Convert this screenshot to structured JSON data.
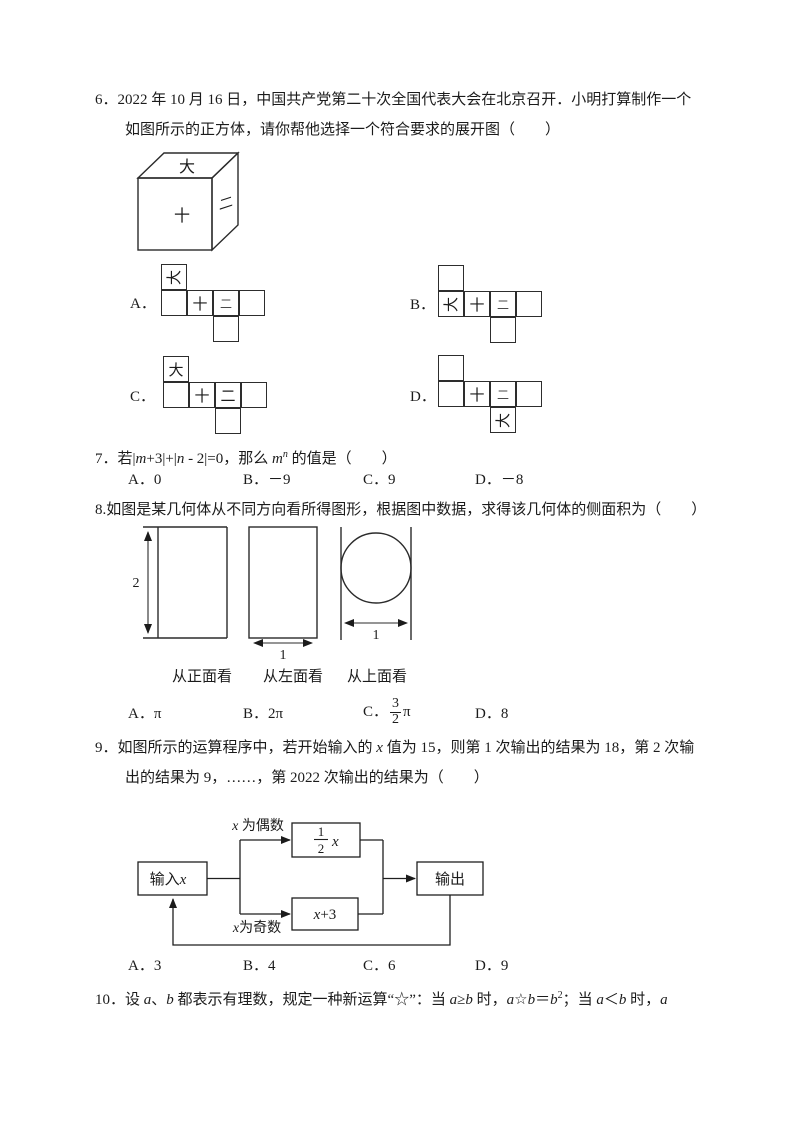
{
  "q6": {
    "num": "6．",
    "line1": "2022 年 10 月 16 日，中国共产党第二十次全国代表大会在北京召开．小明打算制作一个",
    "line2": "如图所示的正方体，请你帮他选择一个符合要求的展开图（　　）",
    "cube": {
      "top": "大",
      "front": "十",
      "side": "二"
    },
    "options": [
      {
        "label": "A．",
        "top": "大",
        "r0": "",
        "r1": "十",
        "r2": "二",
        "r3": "",
        "bottom": ""
      },
      {
        "label": "B．",
        "top": "",
        "r0": "大",
        "r1": "十",
        "r2": "二",
        "r3": "",
        "bottom": ""
      },
      {
        "label": "C．",
        "top": "大",
        "r0": "",
        "r1": "十",
        "r2": "二",
        "r3": "",
        "bottom": ""
      },
      {
        "label": "D．",
        "top": "",
        "r0": "",
        "r1": "十",
        "r2": "二",
        "r3": "",
        "bottom": "大"
      }
    ]
  },
  "q7": {
    "num": "7．",
    "s1": "若|",
    "v1": "m",
    "s2": "+3|+|",
    "v2": "n",
    "s3": " - 2|=0，那么 ",
    "v3": "m",
    "sup": "n",
    "s4": " 的值是（　　）",
    "options": [
      {
        "label": "A．",
        "value": "0"
      },
      {
        "label": "B．",
        "value": "－9"
      },
      {
        "label": "C．",
        "value": "9"
      },
      {
        "label": "D．",
        "value": "－8"
      }
    ]
  },
  "q8": {
    "num": "8.",
    "text": "如图是某几何体从不同方向看所得图形，根据图中数据，求得该几何体的侧面积为（　　）",
    "views": [
      {
        "dim": "2",
        "caption": "从正面看"
      },
      {
        "dim": "1",
        "caption": "从左面看"
      },
      {
        "dim": "1",
        "caption": "从上面看"
      }
    ],
    "options": [
      {
        "label": "A．",
        "value": "π"
      },
      {
        "label": "B．",
        "value": "2π"
      },
      {
        "label": "C．",
        "num": "3",
        "den": "2",
        "suffix": "π"
      },
      {
        "label": "D．",
        "value": "8"
      }
    ]
  },
  "q9": {
    "num": "9．",
    "l1a": "如图所示的运算程序中，若开始输入的 ",
    "l1v": "x",
    "l1b": " 值为 15，则第 1 次输出的结果为 18，第 2 次输",
    "line2": "出的结果为 9，……，第 2022 次输出的结果为（　　）",
    "flow": {
      "input_label": "输入",
      "input_var": "x",
      "even_var": "x",
      "even_label": " 为偶数",
      "odd_var": "x",
      "odd_label": "为奇数",
      "half_num": "1",
      "half_den": "2",
      "half_var": "x",
      "add_var": "x",
      "add_rest": "+3",
      "output_label": "输出"
    },
    "options": [
      {
        "label": "A．",
        "value": "3"
      },
      {
        "label": "B．",
        "value": "4"
      },
      {
        "label": "C．",
        "value": "6"
      },
      {
        "label": "D．",
        "value": "9"
      }
    ]
  },
  "q10": {
    "num": "10．",
    "segs": [
      "设 ",
      "a",
      "、",
      "b",
      " 都表示有理数，规定一种新运算“☆”：当 ",
      "a",
      "≥",
      "b",
      " 时，",
      "a",
      "☆",
      "b",
      "＝",
      "b",
      "2",
      "；当 ",
      "a",
      "＜",
      "b",
      " 时，",
      "a"
    ]
  }
}
